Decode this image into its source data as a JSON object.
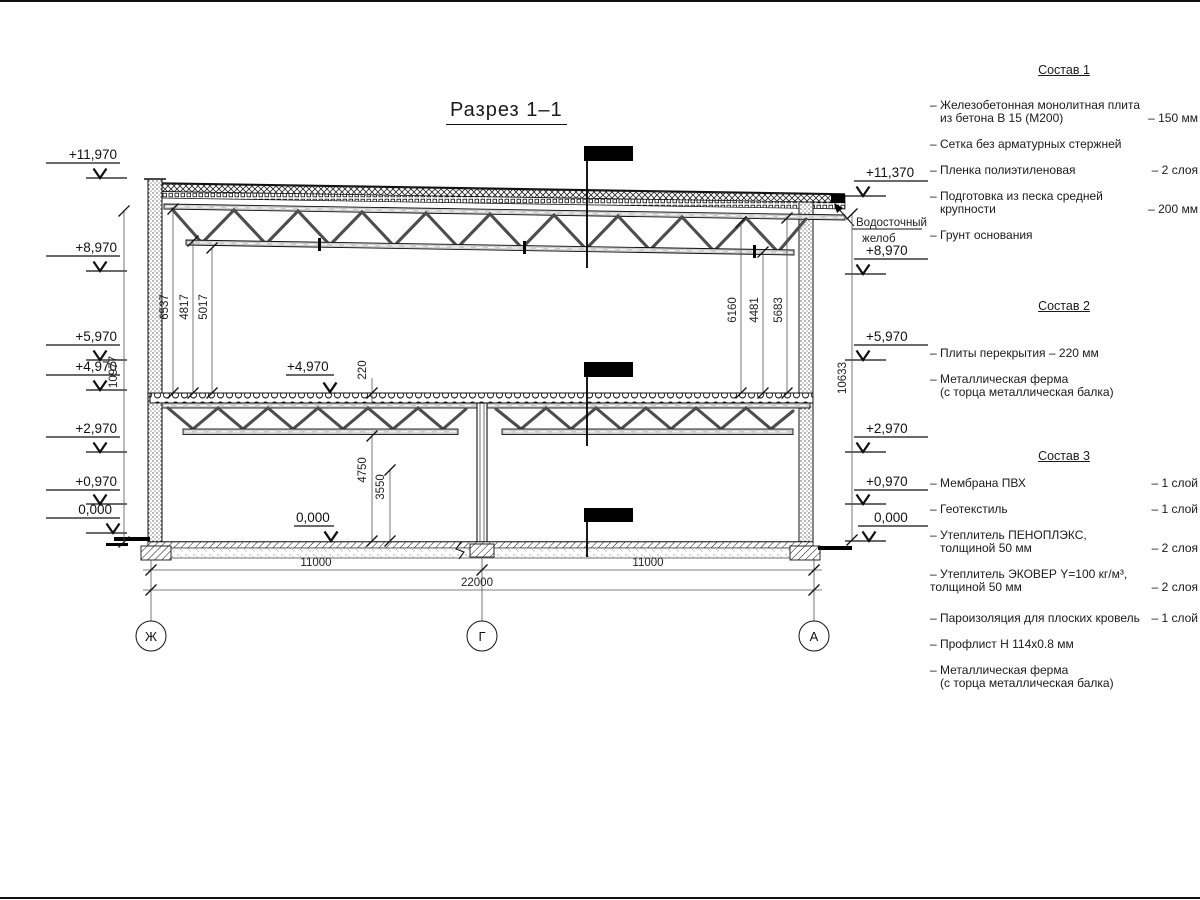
{
  "title": "Разрез 1–1",
  "elev_left": [
    "+11,970",
    "+8,970",
    "+5,970",
    "+4,970",
    "+2,970",
    "+0,970",
    "0,000"
  ],
  "elev_right": [
    "+11,370",
    "+8,970",
    "+5,970",
    "+2,970",
    "+0,970",
    "0,000"
  ],
  "gutter": {
    "line1": "Водосточный",
    "line2": "желоб"
  },
  "interior_marks": {
    "mid_floor": "+4,970",
    "ground": "0,000"
  },
  "dims": {
    "left_heights": [
      "6537",
      "4817",
      "5017"
    ],
    "right_heights": [
      "6160",
      "4481",
      "5683"
    ],
    "left_total": "10977",
    "right_total": "10633",
    "slab_thickness": "220",
    "under_floor": [
      "4750",
      "3550"
    ],
    "span_left": "11000",
    "span_right": "11000",
    "span_total": "22000"
  },
  "axes": [
    "Ж",
    "Г",
    "А"
  ],
  "notes": [
    {
      "title": "Состав 1",
      "items": [
        {
          "l1": "– Железобетонная  монолитная плита",
          "l2": "из бетона В 15 (М200)",
          "v": "– 150 мм"
        },
        {
          "l1": "– Сетка без арматурных стержней"
        },
        {
          "l1": "– Пленка полиэтиленовая",
          "v": "– 2 слоя"
        },
        {
          "l1": "– Подготовка из песка средней",
          "l2": "крупности",
          "v": "– 200 мм"
        },
        {
          "l1": "– Грунт основания"
        }
      ]
    },
    {
      "title": "Состав 2",
      "items": [
        {
          "l1": "– Плиты перекрытия – 220 мм"
        },
        {
          "l1": "– Металлическая ферма",
          "l2": "(с торца металлическая балка)"
        }
      ]
    },
    {
      "title": "Состав 3",
      "items": [
        {
          "l1": "– Мембрана ПВХ",
          "v": "– 1 слой"
        },
        {
          "l1": "– Геотекстиль",
          "v": "– 1 слой"
        },
        {
          "l1": "– Утеплитель ПЕНОПЛЭКС,",
          "l2": "толщиной 50 мм",
          "v": "– 2 слоя"
        },
        {
          "l1": "– Утеплитель ЭКОВЕР Y=100 кг/м³,",
          "l2": "толщиной 50 мм",
          "v": "– 2 слоя"
        },
        {
          "l1": "– Пароизоляция для плоских кровель",
          "v": "– 1 слой"
        },
        {
          "l1": "– Профлист Н 114х0.8 мм"
        },
        {
          "l1": "– Металлическая ферма",
          "l2": "(с торца металлическая балка)"
        }
      ]
    }
  ]
}
